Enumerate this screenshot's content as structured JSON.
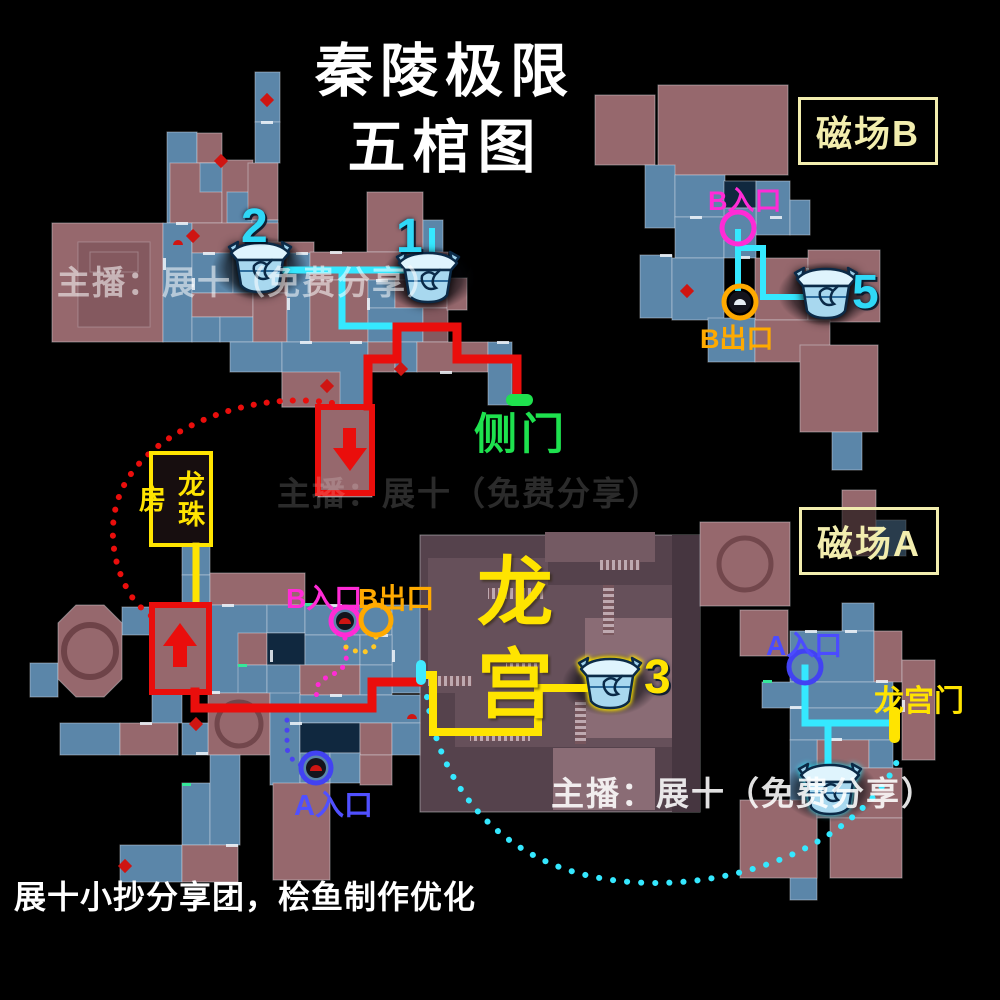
{
  "title": {
    "line1": "秦陵极限",
    "line2": "五棺图"
  },
  "region_boxes": {
    "field_b": "磁场B",
    "field_a": "磁场A"
  },
  "labels": {
    "side_door": "侧门",
    "dragon_pearl_room": "龙珠房",
    "dragon_palace": "龙宫",
    "dragon_palace_gate": "龙宫门",
    "b_entrance_tr": "B入口",
    "b_exit_tr": "B出口",
    "b_entrance_bl": "B入口",
    "b_exit_bl": "B出口",
    "a_entrance_bl": "A入口",
    "a_entrance_br": "A入口"
  },
  "watermarks": {
    "wm1": "主播：展十（免费分享）",
    "wm2": "主播：展十（免费分享）",
    "wm3": "主播：展十（免费分享）"
  },
  "footer": "展十小抄分享团，桧鱼制作优化",
  "colors": {
    "route_red": "#ea0e0c",
    "route_cyan": "#35e8ff",
    "route_yellow": "#ffe400",
    "route_magenta": "#ff2bd6",
    "route_orange": "#ffaa00",
    "route_orange_dots": "#ffc825",
    "route_blue": "#4b43f0",
    "door_green": "#1ee14e",
    "label_yellow": "#f2edae",
    "tile_mauve": "#96686d",
    "tile_mauve_dark": "#84595f",
    "tile_blue": "#5b86a9",
    "tile_navy": "#10283f",
    "palace_base": "#55424c",
    "palace_light": "#8a6c75",
    "chest_number_cyan": "#2fd8f7",
    "chest_number_yellow": "#ffe400"
  },
  "chests": [
    {
      "x": 260,
      "y": 268,
      "num": "2",
      "num_x": 241,
      "num_y": 199,
      "num_color": "#2fd8f7",
      "glow": "dark"
    },
    {
      "x": 428,
      "y": 278,
      "num": "1",
      "num_x": 396,
      "num_y": 209,
      "num_color": "#2fd8f7",
      "glow": "dark"
    },
    {
      "x": 826,
      "y": 294,
      "num": "5",
      "num_x": 852,
      "num_y": 265,
      "num_color": "#2fd8f7",
      "glow": "dark"
    },
    {
      "x": 610,
      "y": 684,
      "num": "3",
      "num_x": 644,
      "num_y": 650,
      "num_color": "#ffe400",
      "glow": "yellow"
    },
    {
      "x": 830,
      "y": 790,
      "num": "",
      "num_x": 0,
      "num_y": 0,
      "num_color": "",
      "glow": "cyan"
    }
  ],
  "map": {
    "tiles": [
      [
        "B",
        255,
        72,
        25,
        50
      ],
      [
        "B",
        255,
        122,
        25,
        41
      ],
      [
        "B",
        167,
        132,
        30,
        91
      ],
      [
        "M",
        197,
        133,
        25,
        30
      ],
      [
        "M",
        170,
        163,
        52,
        60
      ],
      [
        "B",
        200,
        163,
        27,
        29
      ],
      [
        "M",
        222,
        160,
        31,
        93
      ],
      [
        "B",
        227,
        192,
        25,
        31
      ],
      [
        "M",
        248,
        163,
        30,
        57
      ],
      [
        "B",
        252,
        220,
        26,
        33
      ],
      [
        "M",
        52,
        223,
        111,
        119
      ],
      [
        "B",
        163,
        223,
        29,
        119
      ],
      [
        "M",
        192,
        223,
        86,
        30
      ],
      [
        "M",
        252,
        242,
        62,
        51
      ],
      [
        "B",
        192,
        253,
        41,
        40
      ],
      [
        "B",
        233,
        253,
        20,
        40
      ],
      [
        "M",
        192,
        293,
        61,
        24
      ],
      [
        "B",
        192,
        317,
        28,
        25
      ],
      [
        "B",
        220,
        317,
        33,
        25
      ],
      [
        "M",
        253,
        293,
        34,
        49
      ],
      [
        "B",
        287,
        253,
        23,
        89
      ],
      [
        "M",
        367,
        192,
        56,
        60
      ],
      [
        "B",
        423,
        220,
        20,
        32
      ],
      [
        "M",
        310,
        252,
        138,
        28
      ],
      [
        "M",
        310,
        280,
        58,
        62
      ],
      [
        "B",
        368,
        280,
        27,
        28
      ],
      [
        "M",
        395,
        280,
        53,
        28
      ],
      [
        "B",
        368,
        308,
        55,
        34
      ],
      [
        "M2",
        423,
        308,
        25,
        34
      ],
      [
        "M",
        447,
        278,
        20,
        32
      ],
      [
        "B",
        230,
        342,
        52,
        30
      ],
      [
        "B",
        282,
        342,
        86,
        65
      ],
      [
        "M",
        282,
        372,
        58,
        35
      ],
      [
        "M",
        368,
        342,
        27,
        30
      ],
      [
        "B",
        395,
        342,
        22,
        30
      ],
      [
        "M",
        417,
        342,
        71,
        30
      ],
      [
        "B",
        488,
        342,
        24,
        63
      ],
      [
        "M",
        318,
        407,
        54,
        90
      ],
      [
        "M",
        595,
        95,
        60,
        70
      ],
      [
        "M",
        658,
        85,
        130,
        90
      ],
      [
        "B",
        645,
        165,
        30,
        63
      ],
      [
        "B",
        675,
        175,
        50,
        42
      ],
      [
        "N",
        724,
        181,
        32,
        27
      ],
      [
        "B",
        756,
        181,
        34,
        54
      ],
      [
        "B",
        790,
        200,
        20,
        35
      ],
      [
        "B",
        675,
        217,
        49,
        41
      ],
      [
        "B",
        724,
        208,
        32,
        50
      ],
      [
        "B",
        640,
        255,
        32,
        63
      ],
      [
        "B",
        672,
        258,
        52,
        62
      ],
      [
        "M",
        755,
        258,
        53,
        62
      ],
      [
        "M",
        808,
        250,
        72,
        72
      ],
      [
        "B",
        708,
        318,
        47,
        44
      ],
      [
        "M",
        755,
        320,
        75,
        42
      ],
      [
        "M",
        800,
        345,
        78,
        87
      ],
      [
        "B",
        832,
        432,
        30,
        38
      ],
      [
        "B",
        30,
        663,
        28,
        34
      ],
      [
        "B",
        122,
        607,
        31,
        28
      ],
      [
        "M",
        152,
        605,
        56,
        88
      ],
      [
        "B",
        182,
        545,
        28,
        30
      ],
      [
        "B",
        182,
        575,
        28,
        30
      ],
      [
        "M",
        210,
        573,
        95,
        32
      ],
      [
        "B",
        208,
        605,
        59,
        88
      ],
      [
        "M",
        238,
        633,
        29,
        32
      ],
      [
        "B",
        238,
        665,
        29,
        28
      ],
      [
        "B",
        267,
        605,
        38,
        28
      ],
      [
        "N",
        267,
        633,
        38,
        32
      ],
      [
        "B",
        267,
        665,
        33,
        30
      ],
      [
        "B",
        305,
        605,
        87,
        30
      ],
      [
        "B",
        392,
        605,
        28,
        88
      ],
      [
        "B",
        305,
        635,
        55,
        30
      ],
      [
        "B",
        360,
        635,
        32,
        30
      ],
      [
        "M",
        300,
        665,
        60,
        30
      ],
      [
        "B",
        360,
        665,
        32,
        30
      ],
      [
        "B",
        152,
        693,
        30,
        30
      ],
      [
        "M",
        208,
        693,
        62,
        62
      ],
      [
        "B",
        270,
        693,
        30,
        92
      ],
      [
        "B",
        300,
        695,
        120,
        28
      ],
      [
        "B",
        60,
        723,
        60,
        32
      ],
      [
        "M",
        120,
        723,
        58,
        32
      ],
      [
        "B",
        182,
        723,
        26,
        32
      ],
      [
        "N",
        300,
        723,
        60,
        30
      ],
      [
        "M",
        360,
        723,
        32,
        32
      ],
      [
        "B",
        392,
        723,
        28,
        32
      ],
      [
        "B",
        300,
        753,
        30,
        30
      ],
      [
        "B",
        330,
        753,
        30,
        30
      ],
      [
        "M",
        360,
        755,
        32,
        30
      ],
      [
        "M",
        273,
        783,
        57,
        97
      ],
      [
        "B",
        182,
        783,
        28,
        62
      ],
      [
        "B",
        210,
        755,
        30,
        90
      ],
      [
        "B",
        120,
        845,
        62,
        37
      ],
      [
        "M",
        182,
        845,
        56,
        37
      ],
      [
        "M",
        700,
        522,
        90,
        84
      ],
      [
        "M",
        842,
        490,
        34,
        66
      ],
      [
        "B",
        876,
        520,
        30,
        36
      ],
      [
        "M",
        740,
        610,
        48,
        46
      ],
      [
        "B",
        842,
        603,
        32,
        28
      ],
      [
        "B",
        790,
        631,
        84,
        51
      ],
      [
        "M",
        874,
        631,
        28,
        51
      ],
      [
        "B",
        762,
        682,
        131,
        26
      ],
      [
        "B",
        790,
        708,
        105,
        32
      ],
      [
        "M",
        902,
        660,
        33,
        100
      ],
      [
        "M",
        817,
        740,
        52,
        28
      ],
      [
        "B",
        869,
        740,
        24,
        28
      ],
      [
        "B",
        790,
        740,
        27,
        160
      ],
      [
        "M",
        740,
        800,
        77,
        78
      ],
      [
        "M",
        817,
        768,
        85,
        50
      ],
      [
        "M",
        830,
        818,
        72,
        60
      ]
    ],
    "palace": [
      [
        "P0",
        420,
        535,
        280,
        277
      ],
      [
        "P1",
        428,
        558,
        120,
        135
      ],
      [
        "P2",
        545,
        532,
        110,
        30
      ],
      [
        "P1",
        455,
        585,
        245,
        162
      ],
      [
        "P3",
        585,
        618,
        90,
        120
      ],
      [
        "P3",
        553,
        748,
        102,
        62
      ],
      [
        "P4",
        672,
        535,
        28,
        277
      ],
      [
        "ST",
        488,
        588,
        56,
        11
      ],
      [
        "STV",
        603,
        585,
        11,
        50
      ],
      [
        "ST",
        506,
        663,
        40,
        10
      ],
      [
        "ST",
        428,
        676,
        44,
        10
      ],
      [
        "STV",
        575,
        700,
        11,
        44
      ],
      [
        "ST",
        470,
        730,
        60,
        11
      ],
      [
        "ST",
        600,
        560,
        40,
        10
      ]
    ],
    "octagon": {
      "points": "76,605 104,605 122,623 122,679 104,697 76,697 58,679 58,623",
      "wheel": [
        90,
        651,
        26
      ]
    },
    "deco_rects": [
      [
        78,
        242,
        72,
        85
      ],
      [
        90,
        252,
        48,
        20
      ]
    ],
    "deco_circles": [
      [
        239,
        724,
        22
      ],
      [
        745,
        564,
        26
      ]
    ],
    "doors": [
      [
        261,
        121,
        "h"
      ],
      [
        176,
        222,
        "h"
      ],
      [
        203,
        252,
        "h"
      ],
      [
        240,
        252,
        "h"
      ],
      [
        296,
        252,
        "h"
      ],
      [
        330,
        251,
        "h"
      ],
      [
        410,
        251,
        "h"
      ],
      [
        376,
        279,
        "h"
      ],
      [
        300,
        341,
        "h"
      ],
      [
        350,
        341,
        "h"
      ],
      [
        497,
        341,
        "h"
      ],
      [
        440,
        371,
        "h"
      ],
      [
        192,
        278,
        "v"
      ],
      [
        163,
        258,
        "v"
      ],
      [
        287,
        298,
        "v"
      ],
      [
        367,
        298,
        "v"
      ],
      [
        690,
        216,
        "h"
      ],
      [
        770,
        216,
        "h"
      ],
      [
        660,
        254,
        "h"
      ],
      [
        738,
        256,
        "h"
      ],
      [
        806,
        268,
        "v"
      ],
      [
        196,
        604,
        "h"
      ],
      [
        222,
        604,
        "h"
      ],
      [
        330,
        604,
        "h"
      ],
      [
        376,
        634,
        "h"
      ],
      [
        208,
        691,
        "h"
      ],
      [
        330,
        694,
        "h"
      ],
      [
        290,
        722,
        "h"
      ],
      [
        140,
        722,
        "h"
      ],
      [
        196,
        752,
        "h"
      ],
      [
        226,
        844,
        "h"
      ],
      [
        270,
        650,
        "v"
      ],
      [
        392,
        650,
        "v"
      ],
      [
        805,
        630,
        "h"
      ],
      [
        845,
        630,
        "h"
      ],
      [
        876,
        680,
        "h"
      ],
      [
        830,
        738,
        "h"
      ],
      [
        790,
        706,
        "h"
      ],
      [
        902,
        700,
        "v"
      ]
    ],
    "green_dashes": [
      [
        232,
        252
      ],
      [
        305,
        603
      ],
      [
        238,
        664
      ],
      [
        763,
        680
      ],
      [
        182,
        783
      ]
    ],
    "enemies": [
      [
        267,
        100
      ],
      [
        221,
        161
      ],
      [
        193,
        236
      ],
      [
        401,
        369
      ],
      [
        327,
        386
      ],
      [
        687,
        291
      ],
      [
        196,
        724
      ],
      [
        125,
        866
      ]
    ],
    "domes": [
      [
        178,
        245
      ],
      [
        412,
        719
      ]
    ],
    "smudges": [
      [
        260,
        268
      ],
      [
        428,
        278
      ],
      [
        826,
        294
      ],
      [
        610,
        684
      ],
      [
        830,
        790
      ]
    ]
  },
  "routes": {
    "solid": [
      {
        "d": "M265 270 H418",
        "c": "#35e8ff",
        "w": 7
      },
      {
        "d": "M342 270 V326 H396",
        "c": "#35e8ff",
        "w": 7
      },
      {
        "d": "M432 231 V256",
        "c": "#35e8ff",
        "w": 6
      },
      {
        "d": "M368 406 V359 H397 V327 H457 V359 H517 V397",
        "c": "#ea0e0c",
        "w": 9
      },
      {
        "d": "M195 692 V708 H372 V682 H418",
        "c": "#ea0e0c",
        "w": 9
      },
      {
        "d": "M424 675 H433 V732 H538 V688 H590",
        "c": "#ffe400",
        "w": 8
      },
      {
        "d": "M196 546 V604",
        "c": "#ffe400",
        "w": 7
      },
      {
        "d": "M738 232 V288",
        "c": "#35e8ff",
        "w": 6
      },
      {
        "d": "M738 248 H763 V297 H812",
        "c": "#35e8ff",
        "w": 6
      },
      {
        "d": "M805 668 V723 H888",
        "c": "#35e8ff",
        "w": 7
      },
      {
        "d": "M828 723 V770",
        "c": "#35e8ff",
        "w": 7
      }
    ],
    "dotted": [
      {
        "d": "M332 403 C250 390 158 428 127 480 C106 514 109 562 132 597 C140 608 148 614 157 620",
        "c": "#ea0e0c",
        "w": 6,
        "g": 13
      },
      {
        "d": "M427 697 C437 770 480 838 562 868 C652 900 782 880 856 814 C881 792 894 772 901 751",
        "c": "#35e8ff",
        "w": 6,
        "g": 14
      },
      {
        "d": "M345 638 C345 652 349 659 343 667 C334 677 321 676 317 687 L316 702",
        "c": "#ff2bd6",
        "w": 5,
        "g": 10
      },
      {
        "d": "M376 637 C377 648 369 653 358 652 L346 647",
        "c": "#ffc825",
        "w": 5,
        "g": 10
      },
      {
        "d": "M287 710 V746 C287 757 295 763 305 767",
        "c": "#4b43f0",
        "w": 5,
        "g": 10
      }
    ]
  },
  "markers": {
    "circles": [
      {
        "cx": 738,
        "cy": 228,
        "r": 16,
        "c": "#ff2bd6",
        "icon": ""
      },
      {
        "cx": 740,
        "cy": 302,
        "r": 16,
        "c": "#ffaa00",
        "icon": "dark"
      },
      {
        "cx": 345,
        "cy": 621,
        "r": 14,
        "c": "#ff2bd6",
        "icon": "red"
      },
      {
        "cx": 376,
        "cy": 620,
        "r": 15,
        "c": "#ffaa00",
        "icon": ""
      },
      {
        "cx": 316,
        "cy": 768,
        "r": 15,
        "c": "#4242f2",
        "icon": "red"
      },
      {
        "cx": 805,
        "cy": 667,
        "r": 16,
        "c": "#4242f2",
        "icon": ""
      }
    ],
    "pills": [
      {
        "x": 506,
        "y": 394,
        "w": 27,
        "h": 12,
        "rx": 6,
        "c": "#1fe14e",
        "name": "side-door-marker"
      },
      {
        "x": 416,
        "y": 660,
        "w": 10,
        "h": 25,
        "rx": 5,
        "c": "#41eaff",
        "name": "palace-entrance-marker"
      },
      {
        "x": 889,
        "y": 707,
        "w": 11,
        "h": 36,
        "rx": 5,
        "c": "#ffe400",
        "name": "palace-gate-marker"
      }
    ],
    "red_boxes": [
      {
        "x": 318,
        "y": 407,
        "w": 54,
        "h": 86
      },
      {
        "x": 152,
        "y": 605,
        "w": 57,
        "h": 87
      }
    ],
    "arrows": [
      {
        "d": "M343 428 h13 v20 h11 l-17 23 l-17 -23 h10 z",
        "name": "down-arrow-icon"
      },
      {
        "d": "M173 667 v-21 h-10 l17 -23 l17 23 h-10 v21 z",
        "name": "up-arrow-icon"
      }
    ]
  }
}
